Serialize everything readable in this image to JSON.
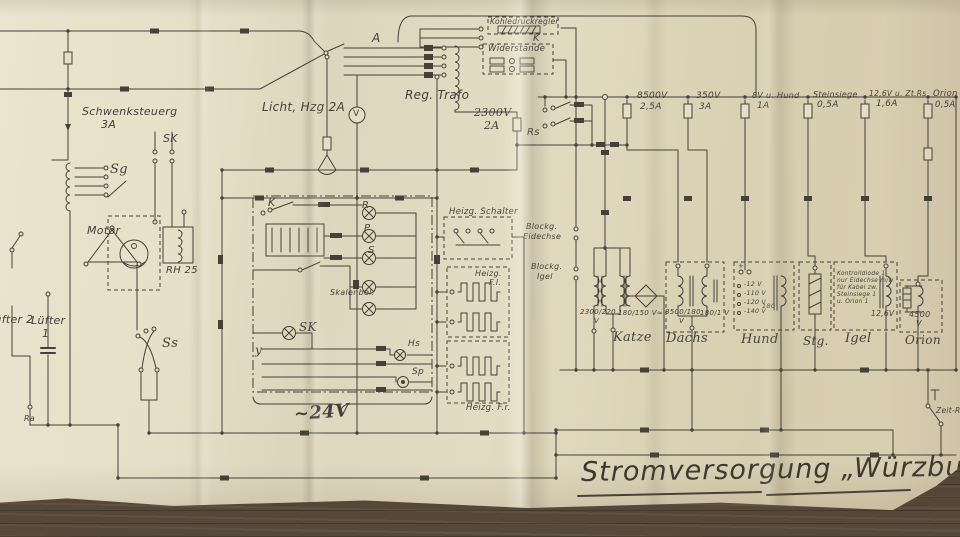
{
  "title": "Stromversorgung „Würzburg“",
  "left_section": {
    "schwenksteuerung": "Schwenksteuerg",
    "schwenksteuerung_rating": "3A",
    "sk_contacts": "SK",
    "sg_selector": "Sg",
    "motor": "Motor",
    "rh_unit": "RH 25",
    "luefter_2": "Lüfter 2",
    "luefter_1": "Lüfter",
    "luefter_1_num": "1",
    "ss_switch": "Ss",
    "ra_terminal": "Ra"
  },
  "top_section": {
    "licht_heizung": "Licht, Hzg 2A",
    "selector_a": "A",
    "reg_trafo": "Reg. Trafo",
    "voltmeter": "V",
    "fuse_2300_v": "2300V",
    "fuse_2300_a": "2A",
    "kohledruckregler": "Kohledruckregler",
    "k_contact": "K",
    "widerstaende": "Widerstände",
    "rs_relay": "Rs"
  },
  "fuse_row": [
    {
      "name": "8500V",
      "rating": "2,5A"
    },
    {
      "name": "350V",
      "rating": "3A"
    },
    {
      "name": "8V u. Hund",
      "rating": "1A"
    },
    {
      "name": "Steinsiege",
      "rating": "0,5A"
    },
    {
      "name": "12,6V u. Zt.Rs",
      "rating": "1,6A"
    },
    {
      "name": "Orion",
      "rating": "0,5A"
    }
  ],
  "control_box": {
    "k_label": "K",
    "lamp_r": "R",
    "lamp_p": "P",
    "lamp_s": "S",
    "skalenbeleuchtung": "Skalenbel.",
    "sk_lamp": "SK",
    "y_terminal": "y",
    "hs_lamp": "Hs",
    "sp_lamp": "Sp",
    "supply_voltage": "~24V"
  },
  "heizung": {
    "schalter": "Heizg. Schalter",
    "front_links_1": "Heizg.",
    "front_links_2": "F.l.",
    "front_rechts": "Heizg. F.r."
  },
  "blocking": {
    "eidechse_1": "Blockg.",
    "eidechse_2": "Eidechse",
    "igel_1": "Blockg.",
    "igel_2": "Igel"
  },
  "transformers": {
    "katze": {
      "name": "Katze",
      "winding_1": "2300/220",
      "winding_1_unit": "V",
      "winding_2": "180/150 V≈"
    },
    "dachs": {
      "name": "Dachs",
      "winding_1": "8500/180",
      "winding_1_unit": "V",
      "winding_2": "180/1 V"
    },
    "hund": {
      "name": "Hund",
      "plus": "+",
      "taps": [
        "-12 V",
        "-110 V",
        "-120 V",
        "-140 V"
      ],
      "tap_value": "180"
    },
    "stg": {
      "name": "Stg."
    },
    "igel": {
      "name": "Igel",
      "voltage": "12,6V",
      "note": [
        "Kontrolldiode 1",
        "nur Eidechse m/w",
        "für Kabel zw.",
        "Steinsiege 1",
        "u. Orion 1"
      ]
    },
    "orion": {
      "name": "Orion",
      "voltage": "4500",
      "voltage_unit": "V"
    }
  },
  "relays": {
    "zeit_rs": "Zeit-Rs"
  },
  "ink_color": "#45403a",
  "paper_color": "#e2dac1"
}
